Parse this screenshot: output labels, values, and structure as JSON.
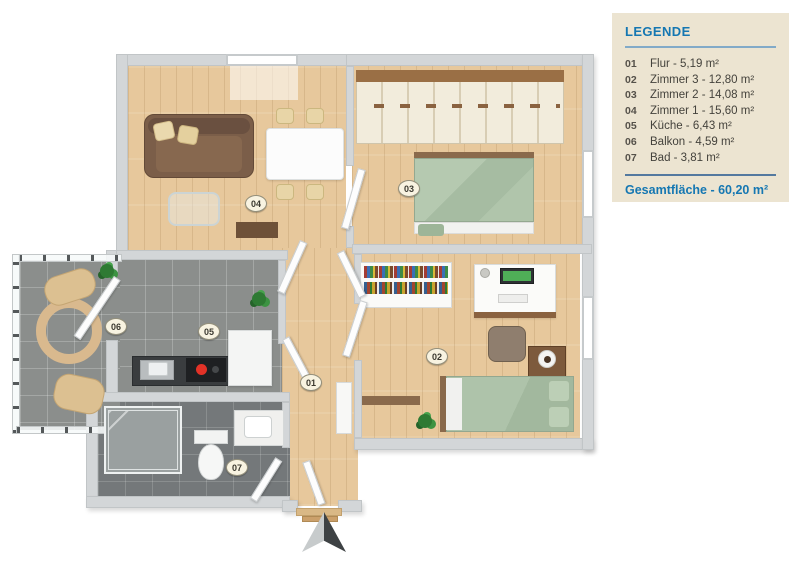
{
  "legend": {
    "title": "LEGENDE",
    "items": [
      {
        "num": "01",
        "label": "Flur - 5,19 m²"
      },
      {
        "num": "02",
        "label": "Zimmer 3 - 12,80 m²"
      },
      {
        "num": "03",
        "label": "Zimmer 2 - 14,08 m²"
      },
      {
        "num": "04",
        "label": "Zimmer 1 - 15,60 m²"
      },
      {
        "num": "05",
        "label": "Küche - 6,43 m²"
      },
      {
        "num": "06",
        "label": "Balkon - 4,59 m²"
      },
      {
        "num": "07",
        "label": "Bad - 3,81 m²"
      }
    ],
    "total": "Gesamtfläche - 60,20 m²"
  },
  "colors": {
    "accent_blue": "#1577b2",
    "legend_bg": "#ece4d1",
    "wall_gray": "#d3d6d8",
    "wood_floor": "#e7c89c",
    "tile_gray": "#8b8e8c",
    "bed_green": "#adc2aa",
    "sofa_brown": "#7b5e49",
    "burner_red": "#e23227"
  }
}
